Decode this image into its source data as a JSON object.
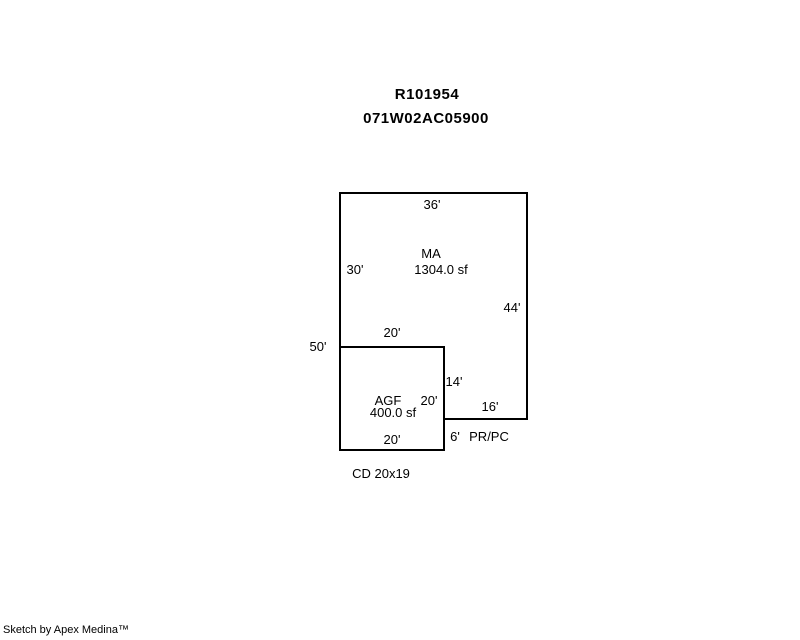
{
  "page": {
    "background": "#ffffff",
    "line_color": "#000000",
    "text_color": "#000000"
  },
  "header": {
    "record_number": "R101954",
    "map_taxlot": "071W02AC05900"
  },
  "sketch": {
    "main_area": {
      "code": "MA",
      "area": "1304.0 sf",
      "dim_top": "36'",
      "dim_left_upper": "30'",
      "dim_right": "44'",
      "dim_step": "20'",
      "dim_left_total": "50'",
      "dim_inner": "14'",
      "dim_bottom": "16'"
    },
    "garage": {
      "code": "AGF",
      "area": "400.0 sf",
      "dim_right": "20'",
      "dim_bottom": "20'"
    },
    "porch": {
      "dim": "6'",
      "code": "PR/PC"
    },
    "note": "CD 20x19"
  },
  "footer": {
    "credit": "Sketch by Apex Medina™"
  }
}
